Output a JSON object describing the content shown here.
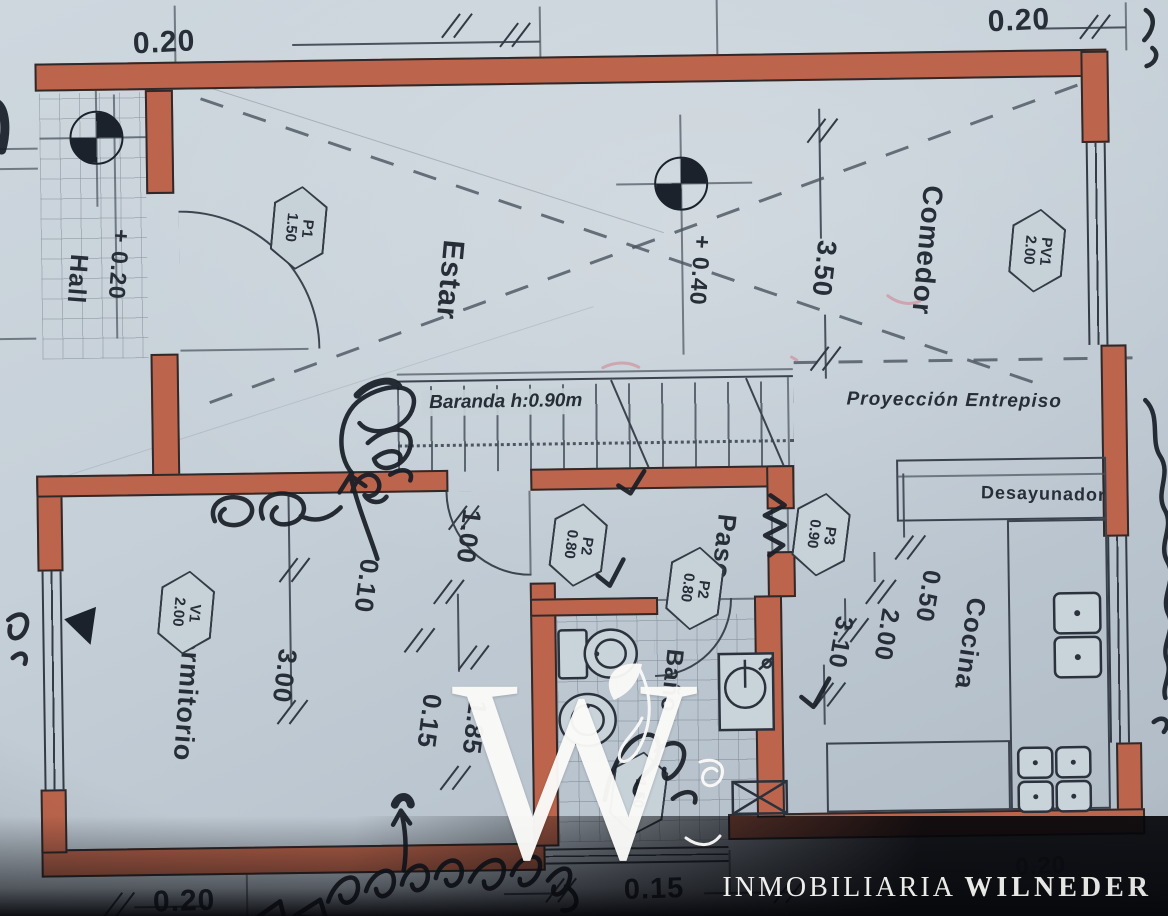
{
  "colors": {
    "wall": "#bd654c",
    "paper": "#c6d0d8",
    "ink": "#262d36",
    "band": "#05060a"
  },
  "plan": {
    "rooms": {
      "hall": "Hall",
      "estar": "Estar",
      "comedor": "Comedor",
      "dormitorio": "Dormitorio",
      "paso": "Paso",
      "bano": "Baño",
      "cocina": "Cocina",
      "desayunador": "Desayunador"
    },
    "levels": {
      "hall": "+ 0.20",
      "living": "+ 0.40"
    },
    "notes": {
      "baranda": "Baranda h:0.90m",
      "entrepiso": "Proyección Entrepiso"
    },
    "tags": [
      {
        "code": "P1",
        "size": "1.50"
      },
      {
        "code": "PV1",
        "size": "2.00"
      },
      {
        "code": "P2",
        "size": "0.80"
      },
      {
        "code": "P2",
        "size": "0.80"
      },
      {
        "code": "P3",
        "size": "0.90"
      },
      {
        "code": "V1",
        "size": "2.00"
      },
      {
        "code": "",
        "size": "1.50"
      }
    ],
    "dims": {
      "top_left": "0.20",
      "top_right": "0.20",
      "comedor_depth": "3.50",
      "dorm_door": "1.00",
      "wall_a": "0.10",
      "dorm_depth": "3.00",
      "bano_depth": "1.85",
      "wall_b": "0.15",
      "cocina_a": "0.50",
      "cocina_b": "2.00",
      "cocina_c": "3.10",
      "bottom_center": "0.15",
      "bottom_left": "0.20",
      "bottom_right": "0.20"
    }
  },
  "watermark": {
    "initial": "W",
    "brand_a": "INMOBILIARIA",
    "brand_b": "WILNEDER"
  }
}
